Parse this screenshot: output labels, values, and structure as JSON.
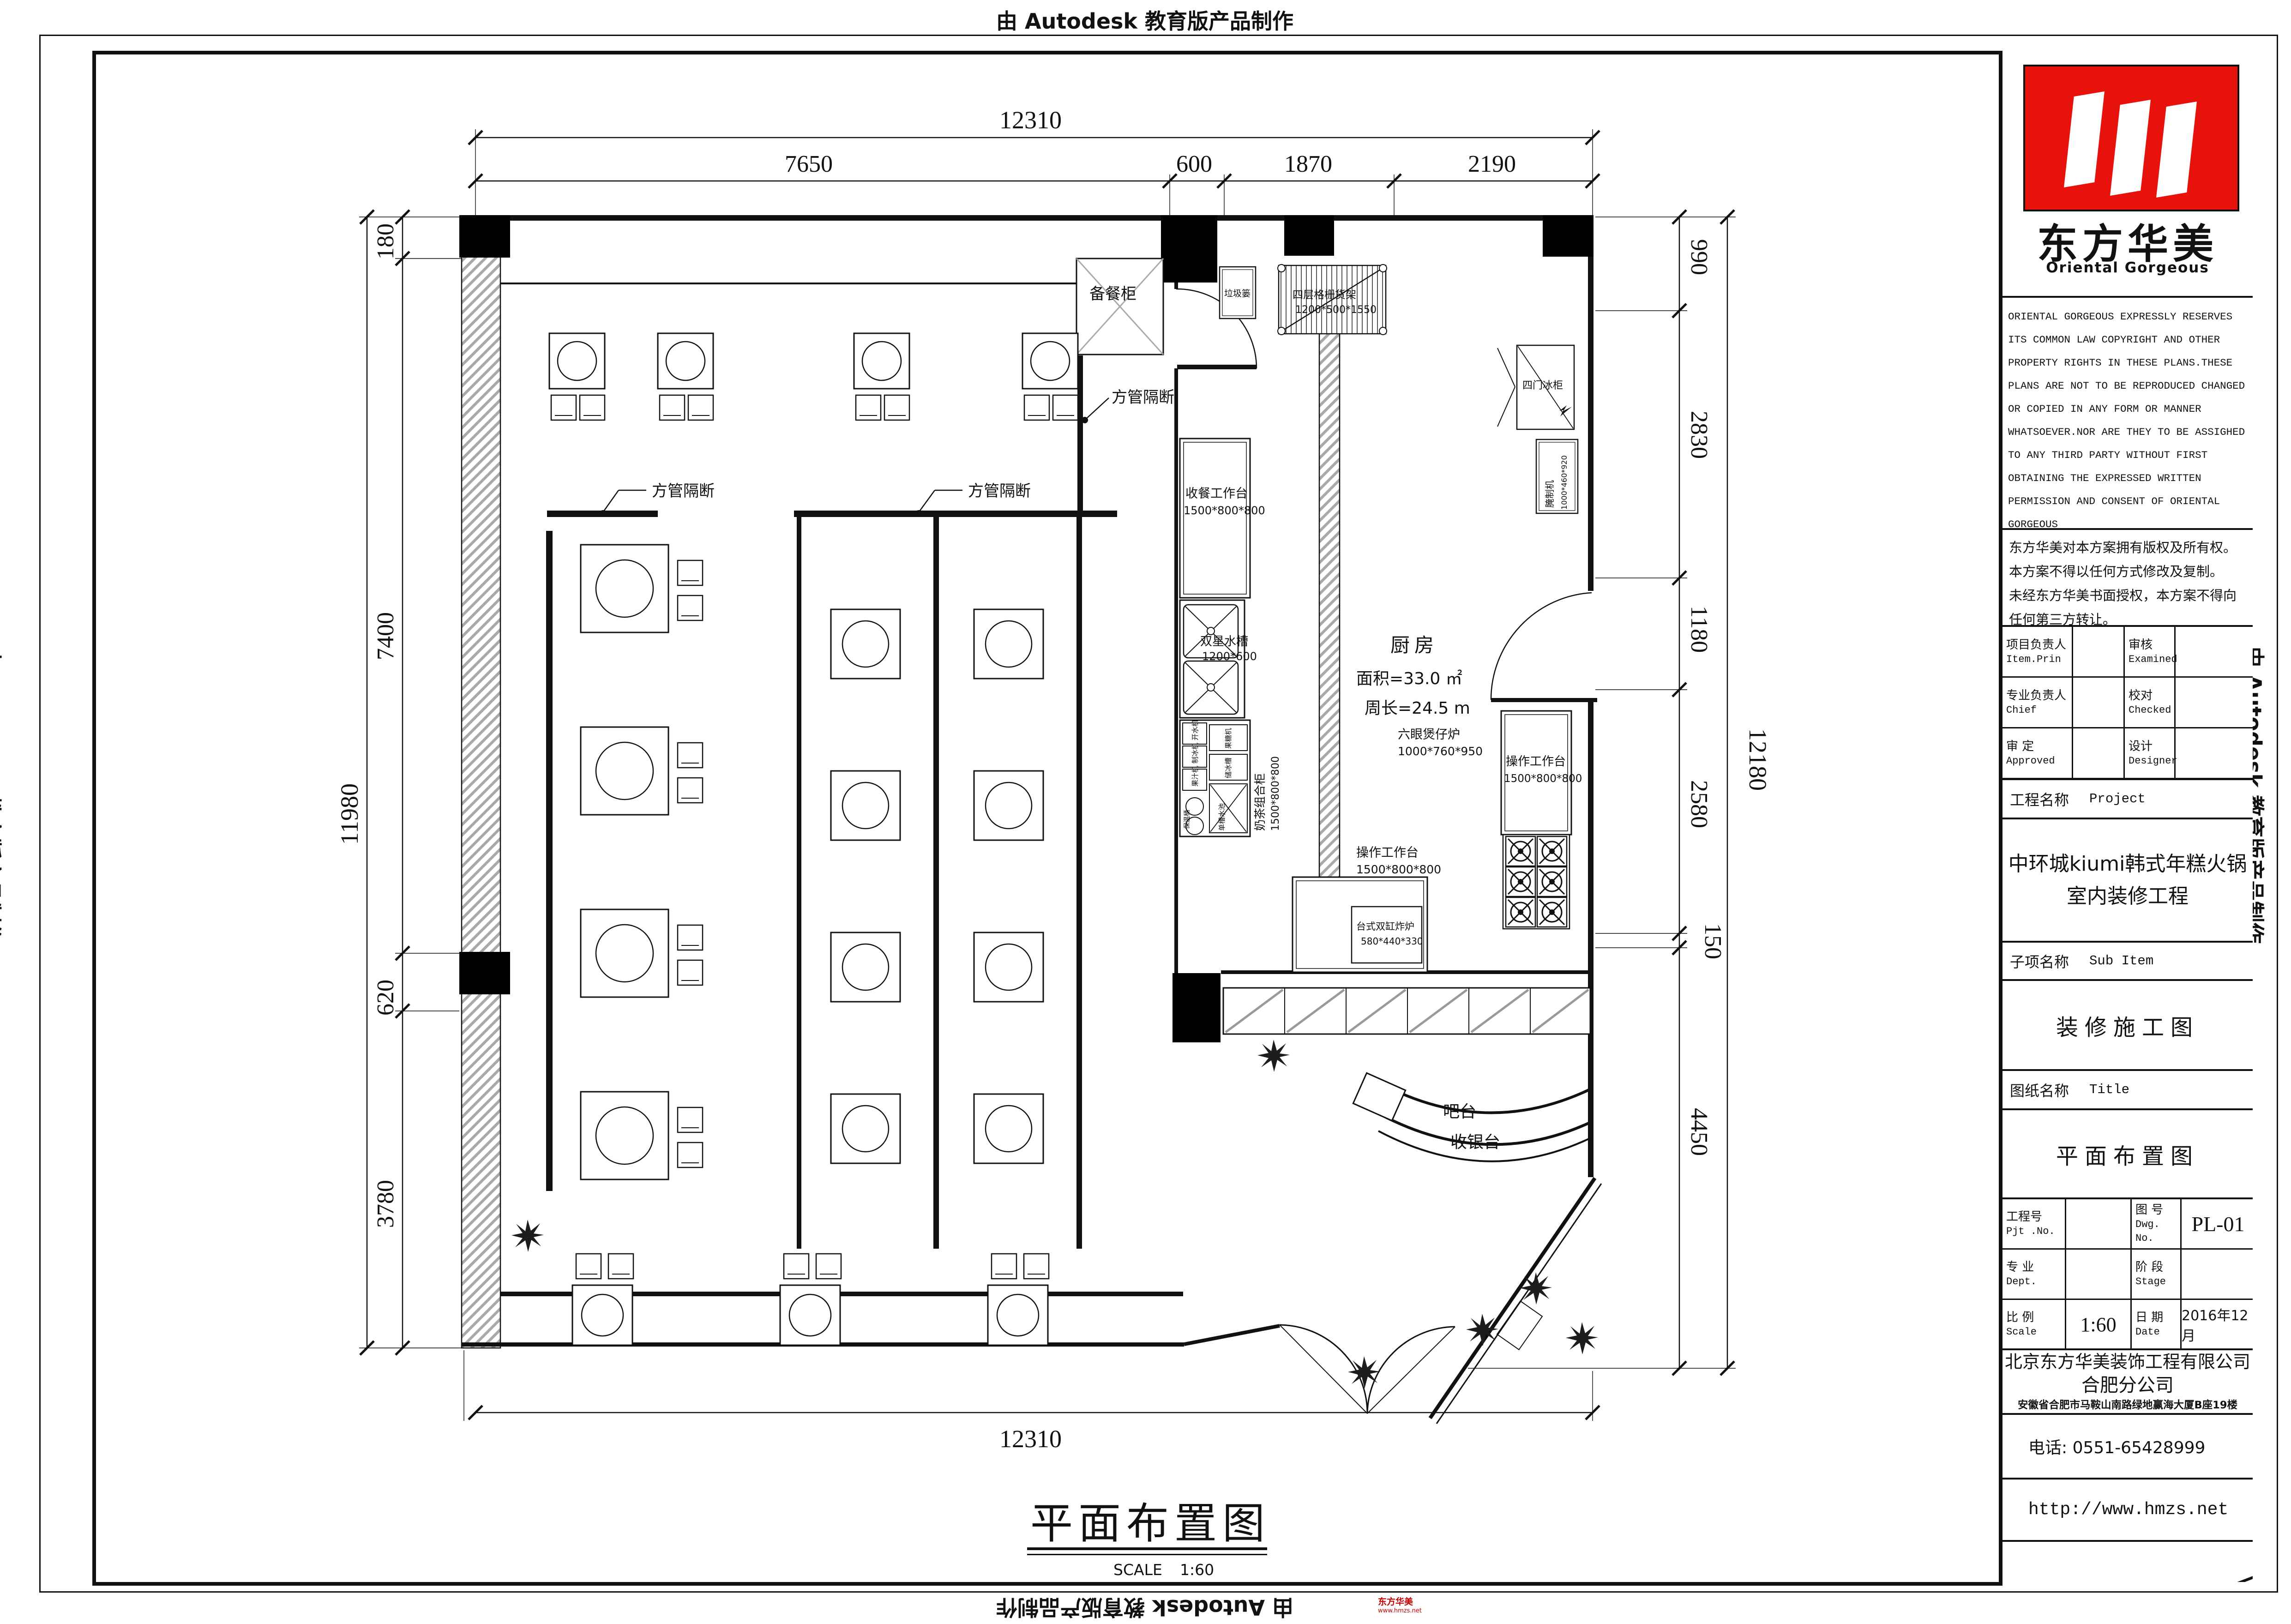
{
  "page": {
    "edge_text": "由 Autodesk 教育版产品制作"
  },
  "dimensions": {
    "top": {
      "total": "12310",
      "segments": [
        "7650",
        "600",
        "1870",
        "2190"
      ]
    },
    "left": {
      "total": "11980",
      "segments": [
        "180",
        "7400",
        "620",
        "3780"
      ]
    },
    "right": {
      "total": "12180",
      "segments": [
        "990",
        "2830",
        "1180",
        "2580",
        "150",
        "4450"
      ]
    },
    "bottom": {
      "total": "12310"
    }
  },
  "plan": {
    "kitchen": {
      "name": "厨房",
      "area": "面积=33.0 ㎡",
      "perimeter": "周长=24.5 m"
    },
    "bar": {
      "line1": "吧台",
      "line2": "收银台"
    },
    "prep_cabinet": "备餐柜",
    "partition": "方管隔断",
    "equipment": {
      "serving_table": {
        "name": "收餐工作台",
        "size": "1500*800*800"
      },
      "sink": {
        "name": "双星水槽",
        "size": "1200*600"
      },
      "tea_cabinet": {
        "name": "奶茶组合柜",
        "size": "1500*800*800",
        "units": {
          "water_boiler": "开水机",
          "ice_maker": "制冰机",
          "juicer": "果汁机",
          "thermal_barrel": "保温桶",
          "fructose": "果糖机",
          "ice_bin": "储冰槽",
          "single_sink": "单槽水池"
        }
      },
      "work_table_south": {
        "name": "操作工作台",
        "size": "1500*800*800"
      },
      "fryer": {
        "name": "台式双缸炸炉",
        "size": "580*440*330"
      },
      "stove": {
        "name": "六眼煲仔炉",
        "size": "1000*760*950"
      },
      "work_table_east": {
        "name": "操作工作台",
        "size": "1500*800*800"
      },
      "shelf": {
        "name": "四层格栅货架",
        "size": "1200*500*1550"
      },
      "trash": "垃圾篓",
      "fridge": "四门冰柜",
      "marinator": {
        "name": "腌制机",
        "size": "1000*460*920"
      }
    }
  },
  "drawing_title": {
    "name": "平面布置图",
    "scale_label": "SCALE",
    "scale_value": "1:60"
  },
  "title_block": {
    "logo": {
      "cn": "东方华美",
      "en": "Oriental Gorgeous"
    },
    "copyright_en": [
      "ORIENTAL GORGEOUS EXPRESSLY RESERVES",
      "ITS COMMON LAW COPYRIGHT AND OTHER",
      "PROPERTY RIGHTS IN THESE PLANS.THESE",
      "PLANS ARE NOT TO BE REPRODUCED CHANGED",
      "OR COPIED IN ANY FORM OR MANNER",
      "WHATSOEVER.NOR ARE THEY TO BE ASSIGHED",
      "TO ANY THIRD PARTY WITHOUT FIRST",
      "OBTAINING THE EXPRESSED WRITTEN",
      "PERMISSION AND CONSENT OF ORIENTAL",
      "GORGEOUS"
    ],
    "copyright_cn": [
      "东方华美对本方案拥有版权及所有权。",
      "本方案不得以任何方式修改及复制。",
      "未经东方华美书面授权，本方案不得向",
      "任何第三方转让。"
    ],
    "personnel": [
      {
        "role_cn": "项目负责人",
        "role_en": "Item.Prin",
        "check_cn": "审核",
        "check_en": "Examined"
      },
      {
        "role_cn": "专业负责人",
        "role_en": "Chief",
        "check_cn": "校对",
        "check_en": "Checked"
      },
      {
        "role_cn": "审 定",
        "role_en": "Approved",
        "check_cn": "设计",
        "check_en": "Designer"
      }
    ],
    "project": {
      "label_cn": "工程名称",
      "label_en": "Project",
      "name_line1": "中环城kiumi韩式年糕火锅",
      "name_line2": "室内装修工程"
    },
    "sub_item": {
      "label_cn": "子项名称",
      "label_en": "Sub Item",
      "value": "装修施工图"
    },
    "sheet": {
      "label_cn": "图纸名称",
      "label_en": "Title",
      "value": "平面布置图"
    },
    "numbers": {
      "pjt_cn": "工程号",
      "pjt_en": "Pjt .No.",
      "dwg_cn": "图 号",
      "dwg_en": "Dwg. No.",
      "dwg_value": "PL-01",
      "dept_cn": "专 业",
      "dept_en": "Dept.",
      "stage_cn": "阶 段",
      "stage_en": "Stage",
      "scale_cn": "比 例",
      "scale_en": "Scale",
      "scale_value": "1:60",
      "date_cn": "日 期",
      "date_en": "Date",
      "date_value": "2016年12月"
    },
    "company": {
      "line1": "北京东方华美装饰工程有限公司",
      "line2": "合肥分公司",
      "address": "安徽省合肥市马鞍山南路绿地赢海大厦B座19楼",
      "phone": "电话: 0551-65428999",
      "website": "http://www.hmzs.net"
    }
  },
  "watermark": {
    "line1": "东方华美",
    "line2": "www.hmzs.net"
  }
}
